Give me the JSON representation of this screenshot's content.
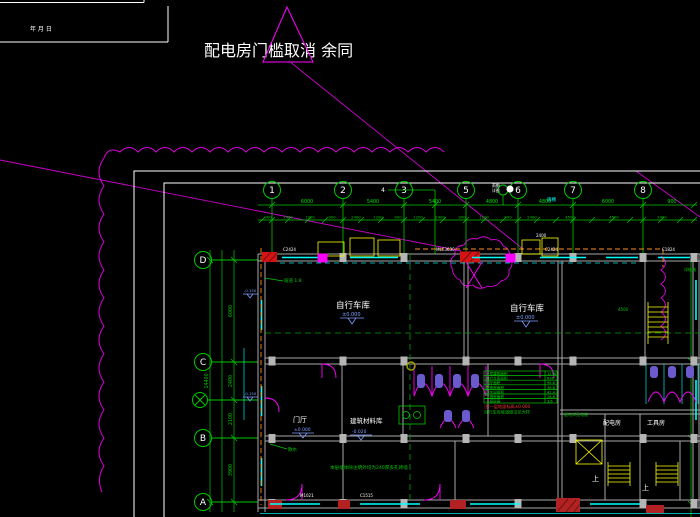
{
  "colors": {
    "background": "#000000",
    "grid_green": "#00c800",
    "magenta": "#ff00ff",
    "cyan": "#00ffff",
    "wall_gray": "#a8a8a8",
    "yellow": "#ffff00",
    "red": "#d41414",
    "blue": "#7ea0ff",
    "orange": "#ff8c1a",
    "purple": "#6a5acd"
  },
  "title_block": {
    "date_fields": "年      月      日"
  },
  "revision": {
    "note": "配电房门槛取消 余同"
  },
  "grid": {
    "cols": [
      {
        "label": "1"
      },
      {
        "label": "2"
      },
      {
        "label": "3"
      },
      {
        "label": "4"
      },
      {
        "label": "5"
      },
      {
        "label": "6"
      },
      {
        "label": "7"
      },
      {
        "label": "8"
      }
    ],
    "rows": [
      {
        "label": "D"
      },
      {
        "label": "C"
      },
      {
        "label": "B"
      },
      {
        "label": "A"
      }
    ]
  },
  "dims": {
    "top_major": [
      "6000",
      "5400",
      "5400",
      "4800",
      "4800",
      "6000",
      "900"
    ],
    "top_minor": [
      "900",
      "2400",
      "1200",
      "900",
      "2400",
      "1200",
      "900",
      "1200",
      "2400",
      "900",
      "1200",
      "900",
      "2400",
      "4500",
      "4500",
      "2400"
    ],
    "left": [
      "6000",
      "2400",
      "2100",
      "3900"
    ],
    "left_total": "14400"
  },
  "rooms": {
    "garage1": {
      "name": "自行车库",
      "elev": "±0.000"
    },
    "garage2": {
      "name": "自行车库",
      "elev": "±0.000"
    },
    "hall": {
      "name": "门厅",
      "elev": "±0.000"
    },
    "material": {
      "name": "建筑材料库",
      "elev": "-0.020"
    },
    "power": {
      "name": "配电房"
    },
    "tool": {
      "name": "工具房"
    },
    "up1": "上",
    "up2": "上"
  },
  "tags": {
    "w1": "C2424",
    "w2": "MLC3630",
    "w3": "C2424",
    "w4": "C1824",
    "d1": "M1021",
    "d2": "C1515",
    "white_dim": "2400",
    "dim_4500": "4500"
  },
  "schedule": {
    "rows": [
      {
        "name": "一层建筑面积",
        "val": "1256"
      },
      {
        "name": "自行车库面积",
        "val": "836"
      },
      {
        "name": "门厅面积",
        "val": "98.6"
      },
      {
        "name": "配电房面积",
        "val": "36.8"
      },
      {
        "name": "卫生间面积",
        "val": "42.4"
      },
      {
        "name": "工具房面积",
        "val": "28.6"
      },
      {
        "name": "一层层高",
        "val": "3.6"
      }
    ],
    "note_red": "注:一层地面标高±0.000",
    "note_green": "自行车库坡道做法见大样"
  },
  "notes": {
    "wall_note": "本层墙体除注明外均为240厚多孔砖墙",
    "ramp": "坡道 1:8",
    "sanshui": "散水",
    "canopy": "雨棚",
    "aux_note1": "雨棚",
    "aux_note2": "详图",
    "struct": "详结施",
    "power_note": "配电详见电施"
  },
  "markers": {
    "m1": "-0.150",
    "m2": "-0.150"
  }
}
